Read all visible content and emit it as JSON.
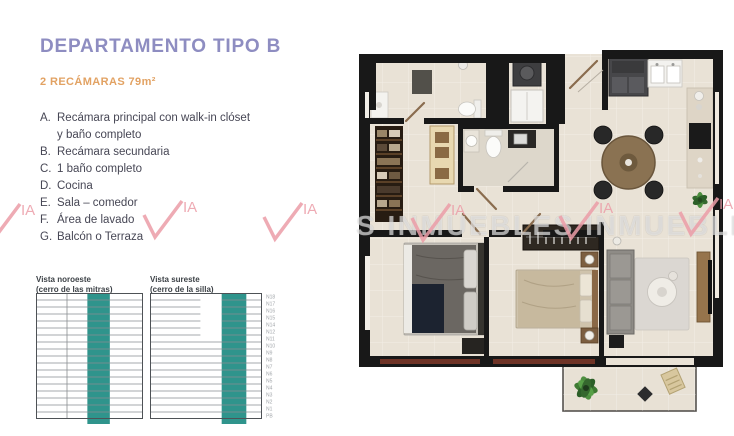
{
  "header": {
    "title": "DEPARTAMENTO TIPO B",
    "subtitle": "2 RECÁMARAS 79m²"
  },
  "features": [
    {
      "letter": "A.",
      "text": "Recámara principal con walk-in clóset\ny baño completo"
    },
    {
      "letter": "B.",
      "text": "Recámara secundaria"
    },
    {
      "letter": "C.",
      "text": "1 baño completo"
    },
    {
      "letter": "D.",
      "text": "Cocina"
    },
    {
      "letter": "E.",
      "text": "Sala – comedor"
    },
    {
      "letter": "F.",
      "text": "Área de lavado"
    },
    {
      "letter": "G.",
      "text": "Balcón o Terraza"
    }
  ],
  "chart_data": [
    {
      "type": "table",
      "title": "Vista noroeste",
      "subtitle": "(cerro de las mitras)",
      "floors_total": 18,
      "highlight_span_pct": [
        48,
        69
      ],
      "divider_pct": 29,
      "short_rows": 0,
      "short_width_pct": 100,
      "labels": []
    },
    {
      "type": "table",
      "title": "Vista sureste",
      "subtitle": "(cerro de la silla)",
      "floors_total": 18,
      "highlight_span_pct": [
        64,
        86
      ],
      "divider_pct": 0,
      "short_rows": 6,
      "short_width_pct": 45,
      "labels": [
        "N18",
        "N17",
        "N16",
        "N15",
        "N14",
        "N12",
        "N11",
        "N10",
        "N9",
        "N8",
        "N7",
        "N6",
        "N5",
        "N4",
        "N3",
        "N2",
        "N1",
        "PB"
      ]
    }
  ],
  "watermark": {
    "band_text": "S INMUEBLES INMUEBLES",
    "logo_text": "IA",
    "pink": "#ec9da8"
  },
  "colors": {
    "accent_purple": "#8e8dc1",
    "accent_orange": "#e2a263",
    "teal_highlight": "#2f948c",
    "body_text": "#474755",
    "grid_line": "#898d90",
    "grid_border": "#4e5256",
    "label_gray": "#a2a6aa"
  }
}
